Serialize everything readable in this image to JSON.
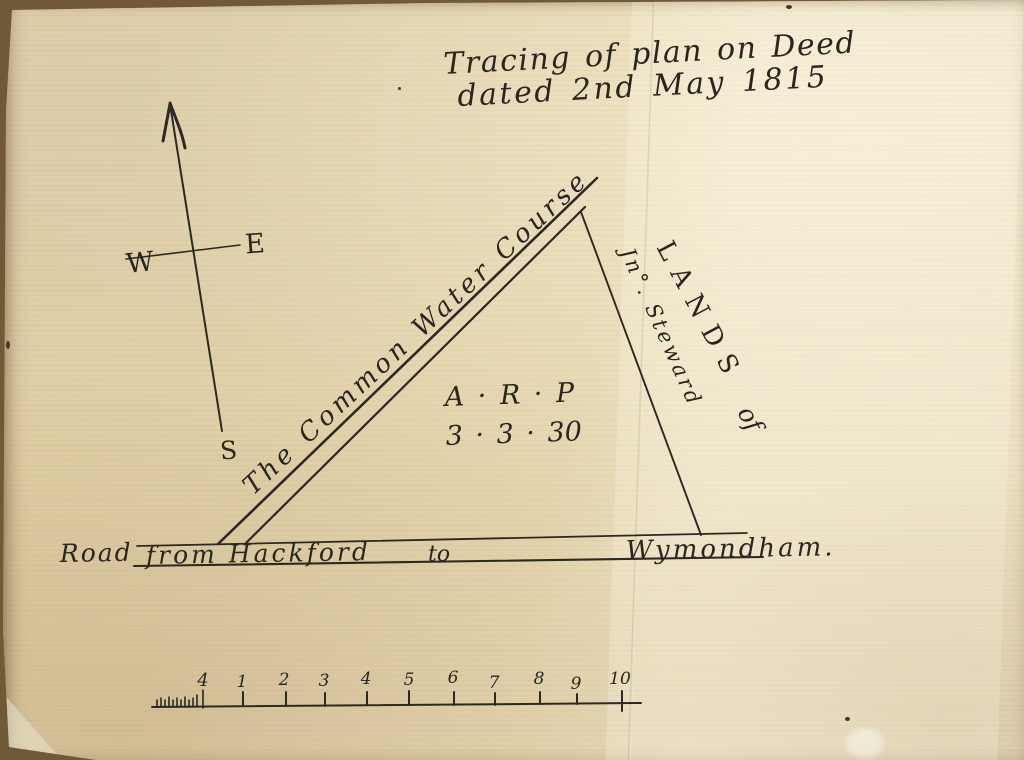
{
  "title": {
    "line1": "Tracing of plan on Deed",
    "line2": "dated 2nd May 1815"
  },
  "compass": {
    "west": "W",
    "east": "E",
    "south": "S"
  },
  "plan": {
    "watercourse_label": "The Common Water Course",
    "lands_label": "LANDS",
    "lands_of": "of",
    "owner_label": "Jn°. Steward",
    "area_header": "A · R · P",
    "area_values": "3 · 3 · 30",
    "road": {
      "name": "Road",
      "from": "from Hackford",
      "to": "to",
      "destination": "Wymondham."
    }
  },
  "scale_bar": {
    "left_label": "4",
    "tick_labels": [
      "1",
      "2",
      "3",
      "4",
      "5",
      "6",
      "7",
      "8",
      "9",
      "10"
    ]
  },
  "colors": {
    "ink": "#2c2823",
    "paper": "#e2d1aa",
    "paper_light": "#eadec0",
    "background_edge": "#6f5936"
  }
}
